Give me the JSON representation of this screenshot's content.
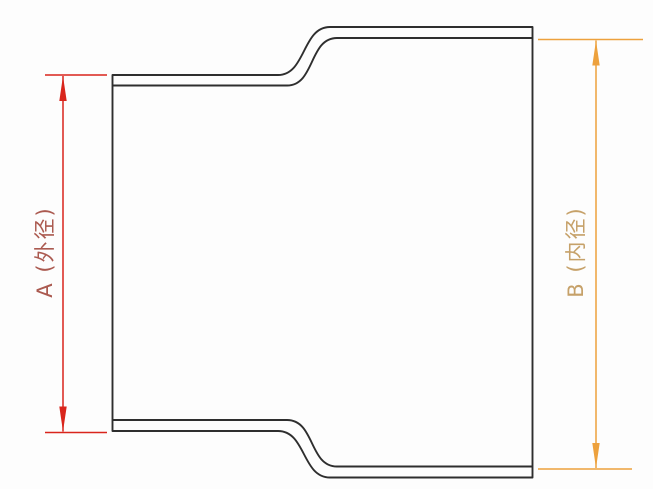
{
  "diagram": {
    "type": "technical-drawing",
    "description": "Cross-section profile of a flared / expanded pipe end with two diameter dimensions",
    "dimension_a": {
      "label": "A (外径)",
      "meaning": "outer diameter",
      "side": "left"
    },
    "dimension_b": {
      "label": "B (内径)",
      "meaning": "inner diameter",
      "side": "right"
    },
    "colors": {
      "outline": "#2e2e2e",
      "dim_a_line": "#d9251c",
      "dim_a_text": "#ab5a50",
      "dim_b_line": "#eda13d",
      "dim_b_text": "#c6a169",
      "background": "#fdfdfd"
    }
  }
}
